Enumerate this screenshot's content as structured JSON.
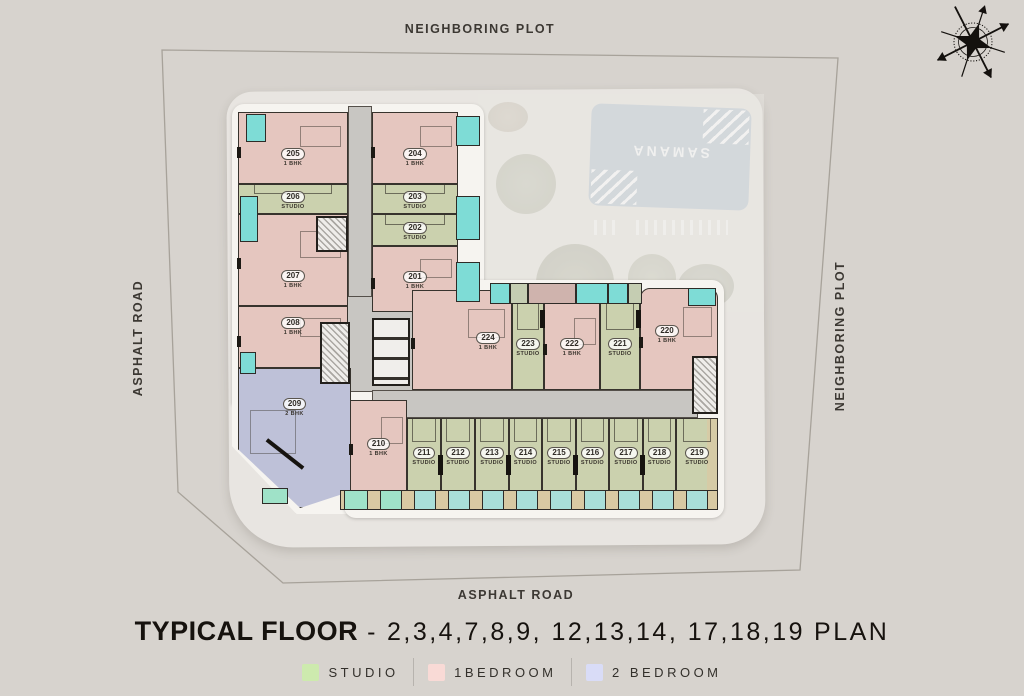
{
  "surroundings": {
    "top": "NEIGHBORING PLOT",
    "left": "ASPHALT ROAD",
    "right": "NEIGHBORING PLOT",
    "bottom": "ASPHALT ROAD"
  },
  "pool": {
    "brand": "SAMANA"
  },
  "title": {
    "main": "TYPICAL FLOOR",
    "separator": "-",
    "floors": "2,3,4,7,8,9, 12,13,14, 17,18,19",
    "suffix": "PLAN"
  },
  "legend": [
    {
      "label": "STUDIO",
      "color": "#cdeaae"
    },
    {
      "label": "1BEDROOM",
      "color": "#f9dad6"
    },
    {
      "label": "2 BEDROOM",
      "color": "#d9dcf7"
    }
  ],
  "colors": {
    "background": "#d7d3ce",
    "studio_unit": "#cbd1ae",
    "one_bedroom_unit": "#e5c6bf",
    "two_bedroom_unit": "#bec1d8",
    "balcony_cyan": "#7edcd6",
    "balcony_mint": "#9fe2c8",
    "balcony_tan": "#d8c9a3",
    "corridor": "#c8c6c2",
    "pool": "#c2ccd6"
  },
  "icons": {
    "compass": "compass-rose-icon"
  },
  "units": {
    "u201": {
      "num": "201",
      "type": "1 BHK"
    },
    "u202": {
      "num": "202",
      "type": "STUDIO"
    },
    "u203": {
      "num": "203",
      "type": "STUDIO"
    },
    "u204": {
      "num": "204",
      "type": "1 BHK"
    },
    "u205": {
      "num": "205",
      "type": "1 BHK"
    },
    "u206": {
      "num": "206",
      "type": "STUDIO"
    },
    "u207": {
      "num": "207",
      "type": "1 BHK"
    },
    "u208": {
      "num": "208",
      "type": "1 BHK"
    },
    "u209": {
      "num": "209",
      "type": "2 BHK"
    },
    "u210": {
      "num": "210",
      "type": "1 BHK"
    },
    "u211": {
      "num": "211",
      "type": "STUDIO"
    },
    "u212": {
      "num": "212",
      "type": "STUDIO"
    },
    "u213": {
      "num": "213",
      "type": "STUDIO"
    },
    "u214": {
      "num": "214",
      "type": "STUDIO"
    },
    "u215": {
      "num": "215",
      "type": "STUDIO"
    },
    "u216": {
      "num": "216",
      "type": "STUDIO"
    },
    "u217": {
      "num": "217",
      "type": "STUDIO"
    },
    "u218": {
      "num": "218",
      "type": "STUDIO"
    },
    "u219": {
      "num": "219",
      "type": "STUDIO"
    },
    "u220": {
      "num": "220",
      "type": "1 BHK"
    },
    "u221": {
      "num": "221",
      "type": "STUDIO"
    },
    "u222": {
      "num": "222",
      "type": "1 BHK"
    },
    "u223": {
      "num": "223",
      "type": "STUDIO"
    },
    "u224": {
      "num": "224",
      "type": "1 BHK"
    }
  }
}
